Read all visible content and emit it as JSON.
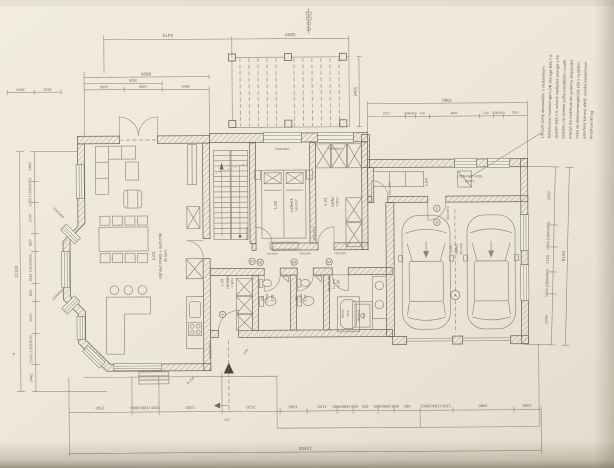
{
  "palette": {
    "paper": "#ece6da",
    "ink": "#6e675c",
    "text": "#5c564c"
  },
  "note": {
    "lines": [
      "Lithium solný akumulátor s vestavěným",
      "bateriovým monitoringem ON Storage ESS 7.0",
      "systém ESS 7.0 uchová nadbytek energie z FV",
      "systému za účelem jejího pozdějšího využití",
      "energii lze směřovat do systému skladování",
      "nebo do elektroenergetické sítě s využitím",
      "uzavřený kovový plášť, vysoká bezpečnost",
      "hmotnost 90 kg"
    ]
  },
  "rooms": [
    {
      "num": "1.01",
      "name": "OBÝVACÍ POKOJ + KUCHYNĚ",
      "area": "45,5m2"
    },
    {
      "num": "1.02",
      "name": "LOŽNICE",
      "area": "16,3m2"
    },
    {
      "num": "1.03",
      "name": "ŠATNA",
      "area": "7,8m2"
    },
    {
      "num": "1.04",
      "name": "TECH. MÍSTNOST",
      "area": "7,4m2"
    },
    {
      "num": "1.05",
      "name": "GARÁŽ",
      "area": "36,1m2"
    },
    {
      "num": "1.06",
      "name": "KOUPELNA",
      "area": "12,4m2"
    },
    {
      "num": "1.07",
      "name": "WC",
      "area": "3,2m2"
    },
    {
      "num": "1.08",
      "name": "WC",
      "area": "3,0m2"
    },
    {
      "num": "1.09",
      "name": "CHODBA",
      "area": "7,6m2"
    }
  ],
  "fixtures": {
    "shower1": "sprchový",
    "shower2": "kout",
    "tub1": "rohová",
    "tub2": "vana"
  },
  "doors": {
    "d800": "800/1970",
    "d700": "700/1970",
    "d900": "900/1970",
    "entry_width": "1030(900)",
    "entry_offset": "230",
    "threshold": "-0,150"
  },
  "markers": {
    "a": "A",
    "b": "B",
    "e": "E",
    "d1": "D1",
    "d2": "D2",
    "d3": "D3",
    "d4": "D4"
  },
  "dims": {
    "top": {
      "t1": "5475",
      "t2": "5800"
    },
    "block9600": {
      "total": "9600",
      "mid": "3020",
      "sub": [
        "2400",
        "1800",
        "4905"
      ]
    },
    "mini": [
      "2400",
      "2400"
    ],
    "pergola_depth": "3455",
    "wing": {
      "total": "7980",
      "sub": [
        "2325",
        "600(900)",
        "875",
        "3000",
        "875",
        "600(900)",
        "1425"
      ]
    },
    "wall_windows": [
      "1000(900)",
      "1000(900)"
    ],
    "left": {
      "total": "11100",
      "sub": [
        "1445",
        "1005 (1500/600)",
        "1530",
        "860",
        "1545 (1500/600)",
        "860",
        "1530",
        "1500 (1000/900)",
        "1445"
      ]
    },
    "right": {
      "total": "8150",
      "sub": [
        "2650",
        "1000 (1800/900)",
        "1150",
        "1000 (1800/900)",
        "2350"
      ]
    },
    "bottom": {
      "total": "14500",
      "offset": "320",
      "sub": [
        "2300",
        "1000 (1000/900)",
        "2300",
        "2120",
        "1000",
        "1100",
        "600 (600/900)",
        "925",
        "600 (600/900)",
        "985",
        "1200 (1000/900)",
        "3400",
        "1000"
      ]
    },
    "cant_windows": [
      "1500/600",
      "1500/600"
    ]
  }
}
